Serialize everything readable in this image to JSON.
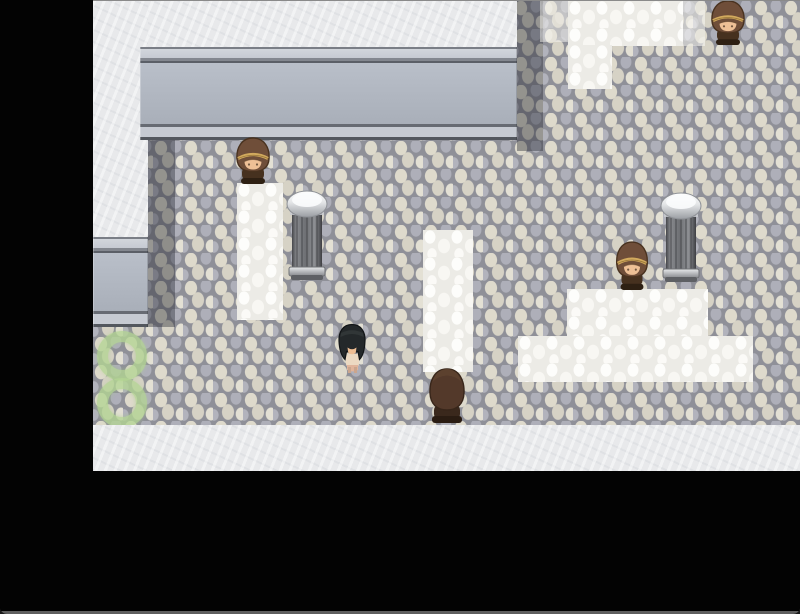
{
  "scene": {
    "title": "RPG Maker style plaza scene with hooded villagers, stone pillars and tiled paths",
    "canvas": {
      "width": 800,
      "height": 614
    },
    "viewport": {
      "x": 93,
      "y": 1,
      "width": 707,
      "height": 470
    },
    "letterboxes": [
      {
        "name": "letterbox-left",
        "rect": [
          0,
          0,
          93,
          614
        ]
      },
      {
        "name": "letterbox-bottom",
        "rect": [
          93,
          471,
          707,
          143
        ]
      }
    ]
  },
  "palette": {
    "letterbox": "#030303",
    "window_edge_top": "#8a8a8a",
    "window_edge_bottom": "#5f5f5f",
    "floor_grout": "#8f9098",
    "floor_pebble_beige": "#dedacc",
    "floor_pebble_gray": "#aeafb9",
    "white_tile": "#fafaf8",
    "marble": "#e8e9eb",
    "wall_face": "#a9afb9",
    "wall_trim_light": "#c6cad2",
    "wall_trim_dark": "#5b5f67",
    "cast_shadow": "rgba(38,39,49,0.40)",
    "moss_green": "#b4d594",
    "hood_brown": "#6f4e39",
    "hood_back_brown": "#53392a",
    "hood_gold_band": "#d2aa5e",
    "skin": "#eec096",
    "player_hair": "#24282a",
    "player_outfit": "#ecd9c2",
    "pillar_cap": "#e2e4e6",
    "pillar_shaft": "#6e7074"
  },
  "map": {
    "regions": [
      {
        "name": "cobblestone-floor",
        "type": "cobble",
        "rect": [
          93,
          1,
          707,
          424
        ]
      },
      {
        "name": "wall-shadow-top",
        "type": "shade",
        "rect": [
          517,
          1,
          26,
          150
        ]
      },
      {
        "name": "wall-shadow-left",
        "type": "shade",
        "rect": [
          148,
          140,
          27,
          187
        ]
      },
      {
        "name": "white-tile-topright-faded",
        "type": "white",
        "rect": [
          540,
          1,
          28,
          41
        ],
        "opacity": 0.5
      },
      {
        "name": "white-tile-topright",
        "type": "white",
        "rect": [
          568,
          1,
          115,
          45
        ]
      },
      {
        "name": "white-tile-topright-edge",
        "type": "white",
        "rect": [
          683,
          1,
          22,
          45
        ],
        "opacity": 0.6
      },
      {
        "name": "white-tile-topright-column",
        "type": "white",
        "rect": [
          568,
          45,
          44,
          44
        ]
      },
      {
        "name": "white-tile-path-left",
        "type": "white",
        "rect": [
          237,
          183,
          46,
          137
        ]
      },
      {
        "name": "white-tile-path-middle",
        "type": "white",
        "rect": [
          423,
          230,
          50,
          142
        ]
      },
      {
        "name": "white-tile-step-upper",
        "type": "white",
        "rect": [
          567,
          289,
          141,
          47
        ]
      },
      {
        "name": "white-tile-step-lower",
        "type": "white",
        "rect": [
          518,
          336,
          235,
          46
        ]
      },
      {
        "name": "moss-ring-eight",
        "type": "moss8",
        "rect": [
          94,
          331,
          58,
          97
        ]
      },
      {
        "name": "marble-ledge-top",
        "type": "marble",
        "rect": [
          93,
          1,
          424,
          46
        ]
      },
      {
        "name": "marble-column-left",
        "type": "marble",
        "rect": [
          93,
          1,
          55,
          236
        ]
      },
      {
        "name": "wall-top",
        "type": "wall",
        "rect": [
          140,
          47,
          377,
          93
        ]
      },
      {
        "name": "wall-left",
        "type": "wall",
        "rect": [
          93,
          237,
          55,
          90
        ]
      },
      {
        "name": "marble-walkway-bottom",
        "type": "marble",
        "rect": [
          93,
          425,
          707,
          46
        ]
      }
    ]
  },
  "entities": [
    {
      "name": "npc-hooded-topright",
      "type": "npc-down",
      "rect": [
        706,
        0,
        44,
        46
      ],
      "facing": "down",
      "interactable": true
    },
    {
      "name": "npc-hooded-left",
      "type": "npc-down",
      "rect": [
        231,
        137,
        44,
        48
      ],
      "facing": "down",
      "interactable": true
    },
    {
      "name": "pillar-left",
      "type": "pillar",
      "rect": [
        284,
        189,
        46,
        93
      ],
      "interactable": false
    },
    {
      "name": "pillar-right",
      "type": "pillar",
      "rect": [
        658,
        191,
        46,
        93
      ],
      "interactable": false
    },
    {
      "name": "npc-hooded-right",
      "type": "npc-down",
      "rect": [
        611,
        241,
        42,
        50
      ],
      "facing": "down",
      "interactable": true
    },
    {
      "name": "player-character",
      "type": "player",
      "rect": [
        335,
        323,
        34,
        51
      ],
      "facing": "down",
      "interactable": false
    },
    {
      "name": "npc-hooded-back",
      "type": "npc-up",
      "rect": [
        424,
        367,
        46,
        58
      ],
      "facing": "up",
      "interactable": true
    }
  ]
}
